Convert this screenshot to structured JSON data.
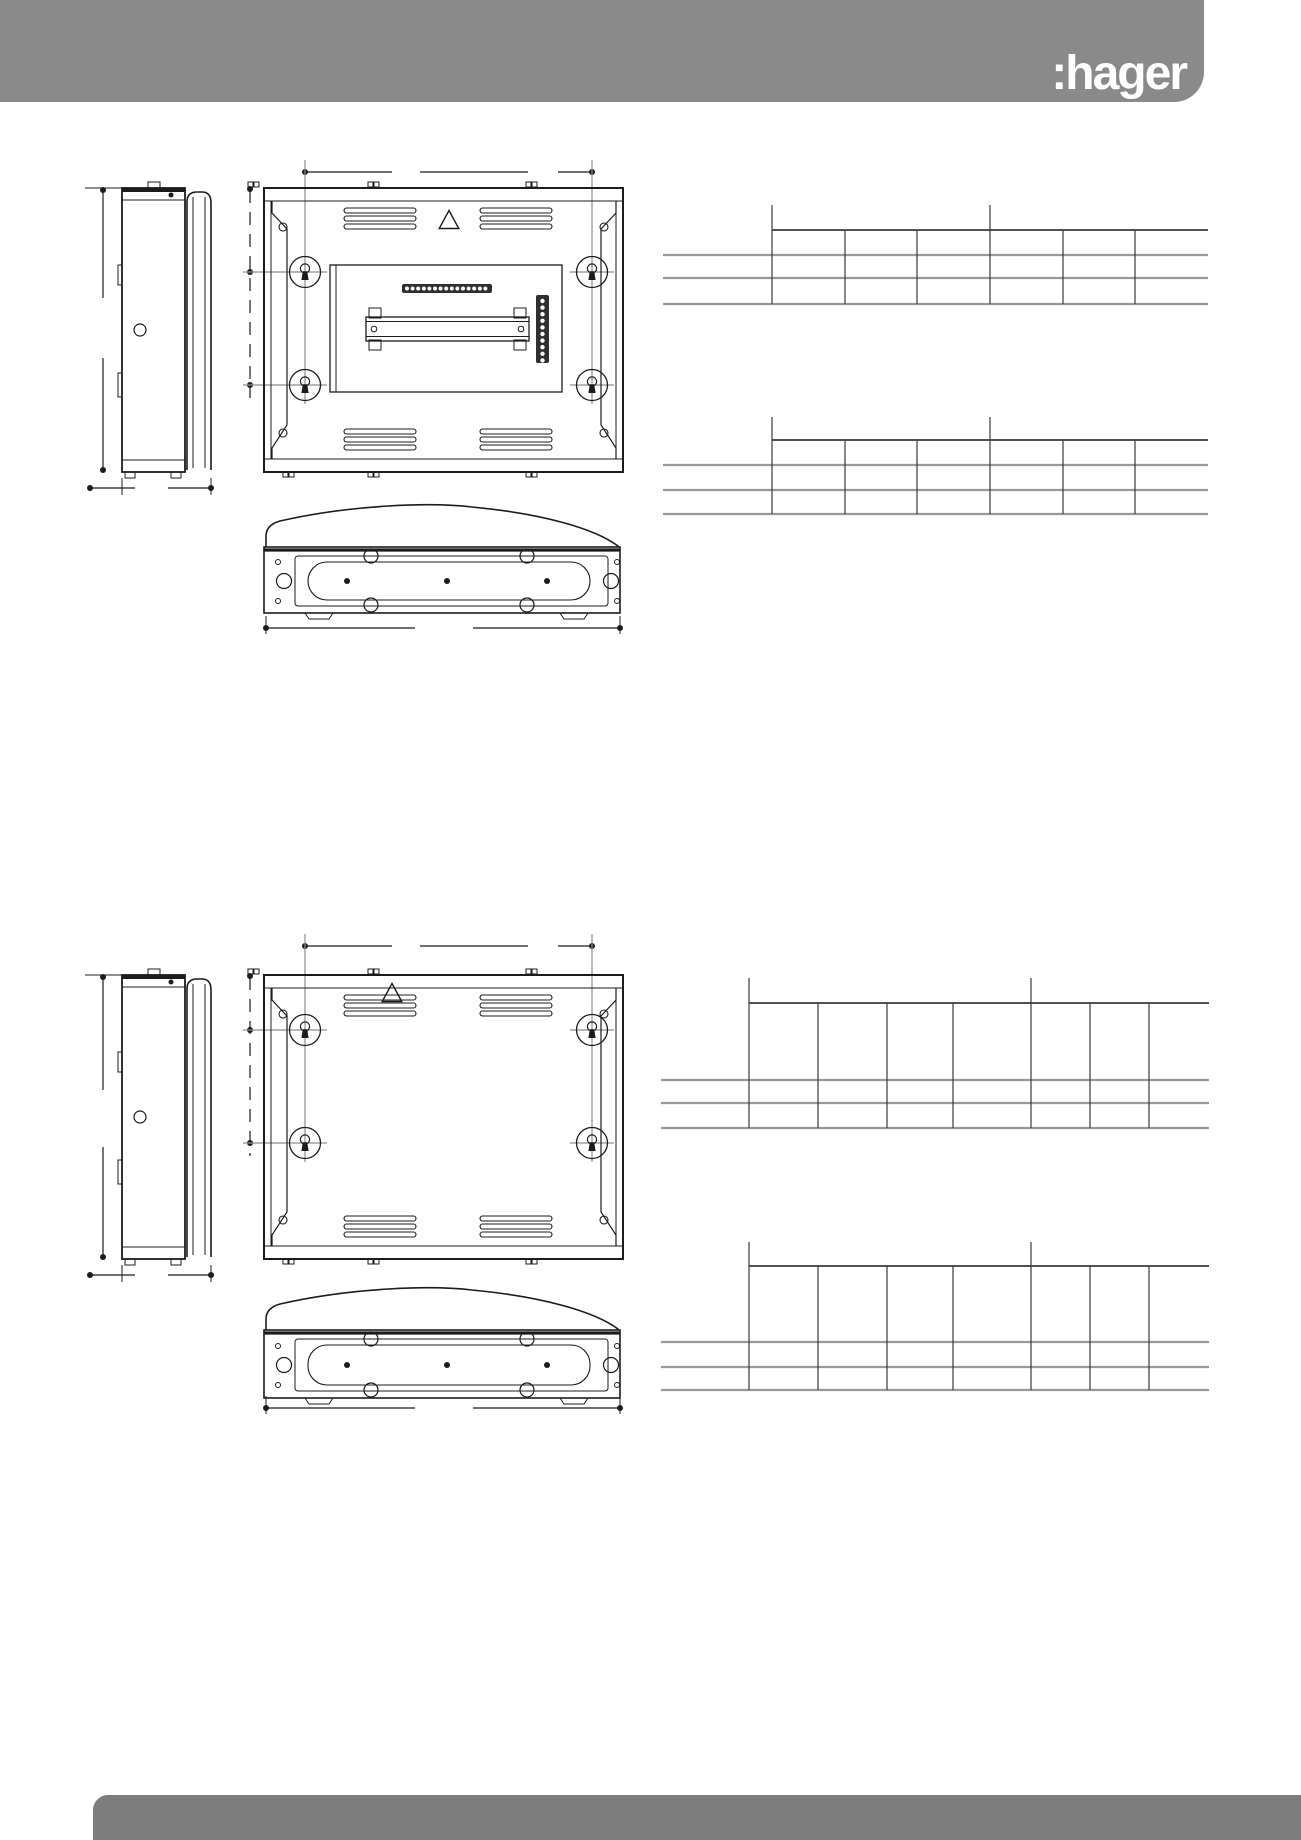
{
  "page": {
    "width": 1301,
    "height": 1840,
    "background": "#ffffff"
  },
  "header": {
    "logo": ":hager",
    "bg_color": "#8a8a8a",
    "text_color": "#ffffff"
  },
  "footer": {
    "bg_color": "#7d7d7d"
  },
  "drawings": {
    "enclosure_top": {
      "views": [
        "side-view",
        "front-view",
        "bottom-view"
      ],
      "features": [
        "wall-fixing-keyholes",
        "ventilation-louvres",
        "warning-triangle",
        "din-rail",
        "terminal-blocks",
        "dimension-lines"
      ],
      "keyhole_count": 4,
      "vent_groups_top": 2,
      "vent_groups_bottom": 2
    },
    "enclosure_bottom": {
      "views": [
        "side-view",
        "front-view",
        "bottom-view"
      ],
      "features": [
        "wall-fixing-keyholes",
        "ventilation-louvres",
        "warning-triangle",
        "dimension-lines"
      ],
      "keyhole_count": 4,
      "vent_groups_top": 2,
      "vent_groups_bottom": 2
    }
  },
  "tables": [
    {
      "id": "table-1",
      "data_columns": 6,
      "header_rows": 1,
      "data_rows": 2,
      "group_ticks": 2,
      "cells": "empty"
    },
    {
      "id": "table-2",
      "data_columns": 6,
      "header_rows": 1,
      "data_rows": 2,
      "group_ticks": 2,
      "cells": "empty"
    },
    {
      "id": "table-3",
      "data_columns": 7,
      "header_rows": 1,
      "data_rows": 2,
      "group_ticks": 2,
      "cells": "empty"
    },
    {
      "id": "table-4",
      "data_columns": 7,
      "header_rows": 1,
      "data_rows": 2,
      "group_ticks": 2,
      "cells": "empty"
    }
  ]
}
